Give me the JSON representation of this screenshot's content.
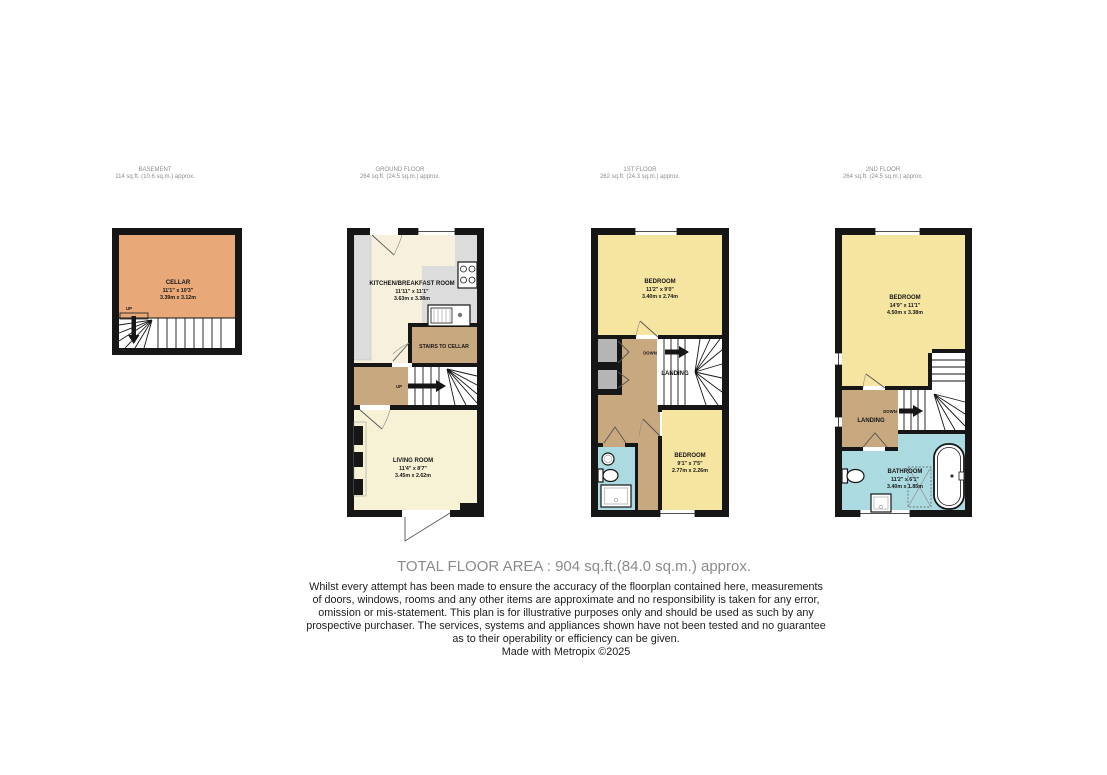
{
  "colors": {
    "wall": "#161616",
    "cellar": "#e8a878",
    "kitchen": "#f6f0dc",
    "living": "#f7f2d6",
    "bedroom": "#f5e5a0",
    "landing_tan": "#c8a87e",
    "bathroom_teal": "#abdbe0",
    "counter_gray": "#dcdcdc",
    "cupboard_gray": "#b5b5b5",
    "header_gray": "#8e8e8e",
    "total_gray": "#8b8b8b"
  },
  "floors": [
    {
      "id": "basement",
      "header": {
        "title": "BASEMENT",
        "area": "114 sq.ft. (10.6 sq.m.) approx."
      },
      "rooms": [
        {
          "name": "CELLAR",
          "imperial": "11'1\" x 10'3\"",
          "metric": "3.39m x 3.12m"
        }
      ],
      "labels": {
        "up": "UP"
      }
    },
    {
      "id": "ground-floor",
      "header": {
        "title": "GROUND FLOOR",
        "area": "264 sq.ft. (24.5 sq.m.) approx."
      },
      "rooms": [
        {
          "name": "KITCHEN/BREAKFAST ROOM",
          "imperial": "11'11\" x 11'1\"",
          "metric": "3.63m x 3.38m"
        },
        {
          "name": "LIVING ROOM",
          "imperial": "11'4\" x 8'7\"",
          "metric": "3.45m x 2.62m"
        }
      ],
      "labels": {
        "stairs_to_cellar": "STAIRS TO CELLAR",
        "up": "UP"
      }
    },
    {
      "id": "first-floor",
      "header": {
        "title": "1ST FLOOR",
        "area": "262 sq.ft. (24.3 sq.m.) approx."
      },
      "rooms": [
        {
          "name": "BEDROOM",
          "imperial": "11'2\" x 9'0\"",
          "metric": "3.40m x 2.74m"
        },
        {
          "name": "BEDROOM",
          "imperial": "9'1\" x 7'5\"",
          "metric": "2.77m x 2.26m"
        }
      ],
      "labels": {
        "down": "DOWN",
        "landing": "LANDING"
      }
    },
    {
      "id": "second-floor",
      "header": {
        "title": "2ND FLOOR",
        "area": "264 sq.ft. (24.5 sq.m.) approx."
      },
      "rooms": [
        {
          "name": "BEDROOM",
          "imperial": "14'9\" x 11'1\"",
          "metric": "4.50m x 3.38m"
        },
        {
          "name": "BATHROOM",
          "imperial": "11'2\" x 6'1\"",
          "metric": "3.40m x 1.85m"
        }
      ],
      "labels": {
        "down": "DOWN",
        "landing": "LANDING"
      }
    }
  ],
  "footer": {
    "total_area": "TOTAL FLOOR AREA : 904 sq.ft.(84.0 sq.m.) approx.",
    "disclaimer": [
      "Whilst every attempt has been made to ensure the accuracy of the floorplan contained here, measurements",
      "of doors, windows, rooms and any other items are approximate and no responsibility is taken for any error,",
      "omission or mis-statement. This plan is for illustrative purposes only and should be used as such by any",
      "prospective purchaser. The services, systems and appliances shown have not been tested and no guarantee",
      "as to their operability or efficiency can be given."
    ],
    "credit": "Made with Metropix ©2025"
  }
}
